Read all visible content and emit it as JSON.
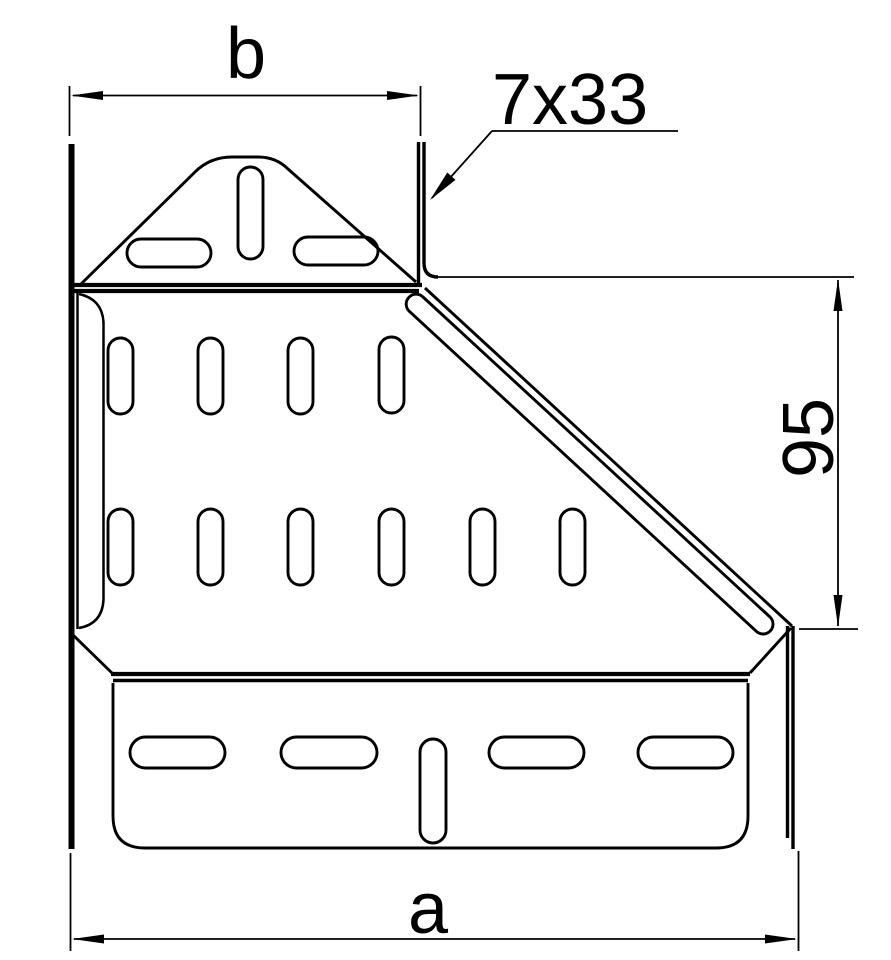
{
  "drawing": {
    "labels": {
      "width_top": "b",
      "width_bottom": "a",
      "height_right": "95",
      "slot_callout": "7x33"
    },
    "colors": {
      "line": "#000000",
      "background": "#ffffff"
    }
  }
}
